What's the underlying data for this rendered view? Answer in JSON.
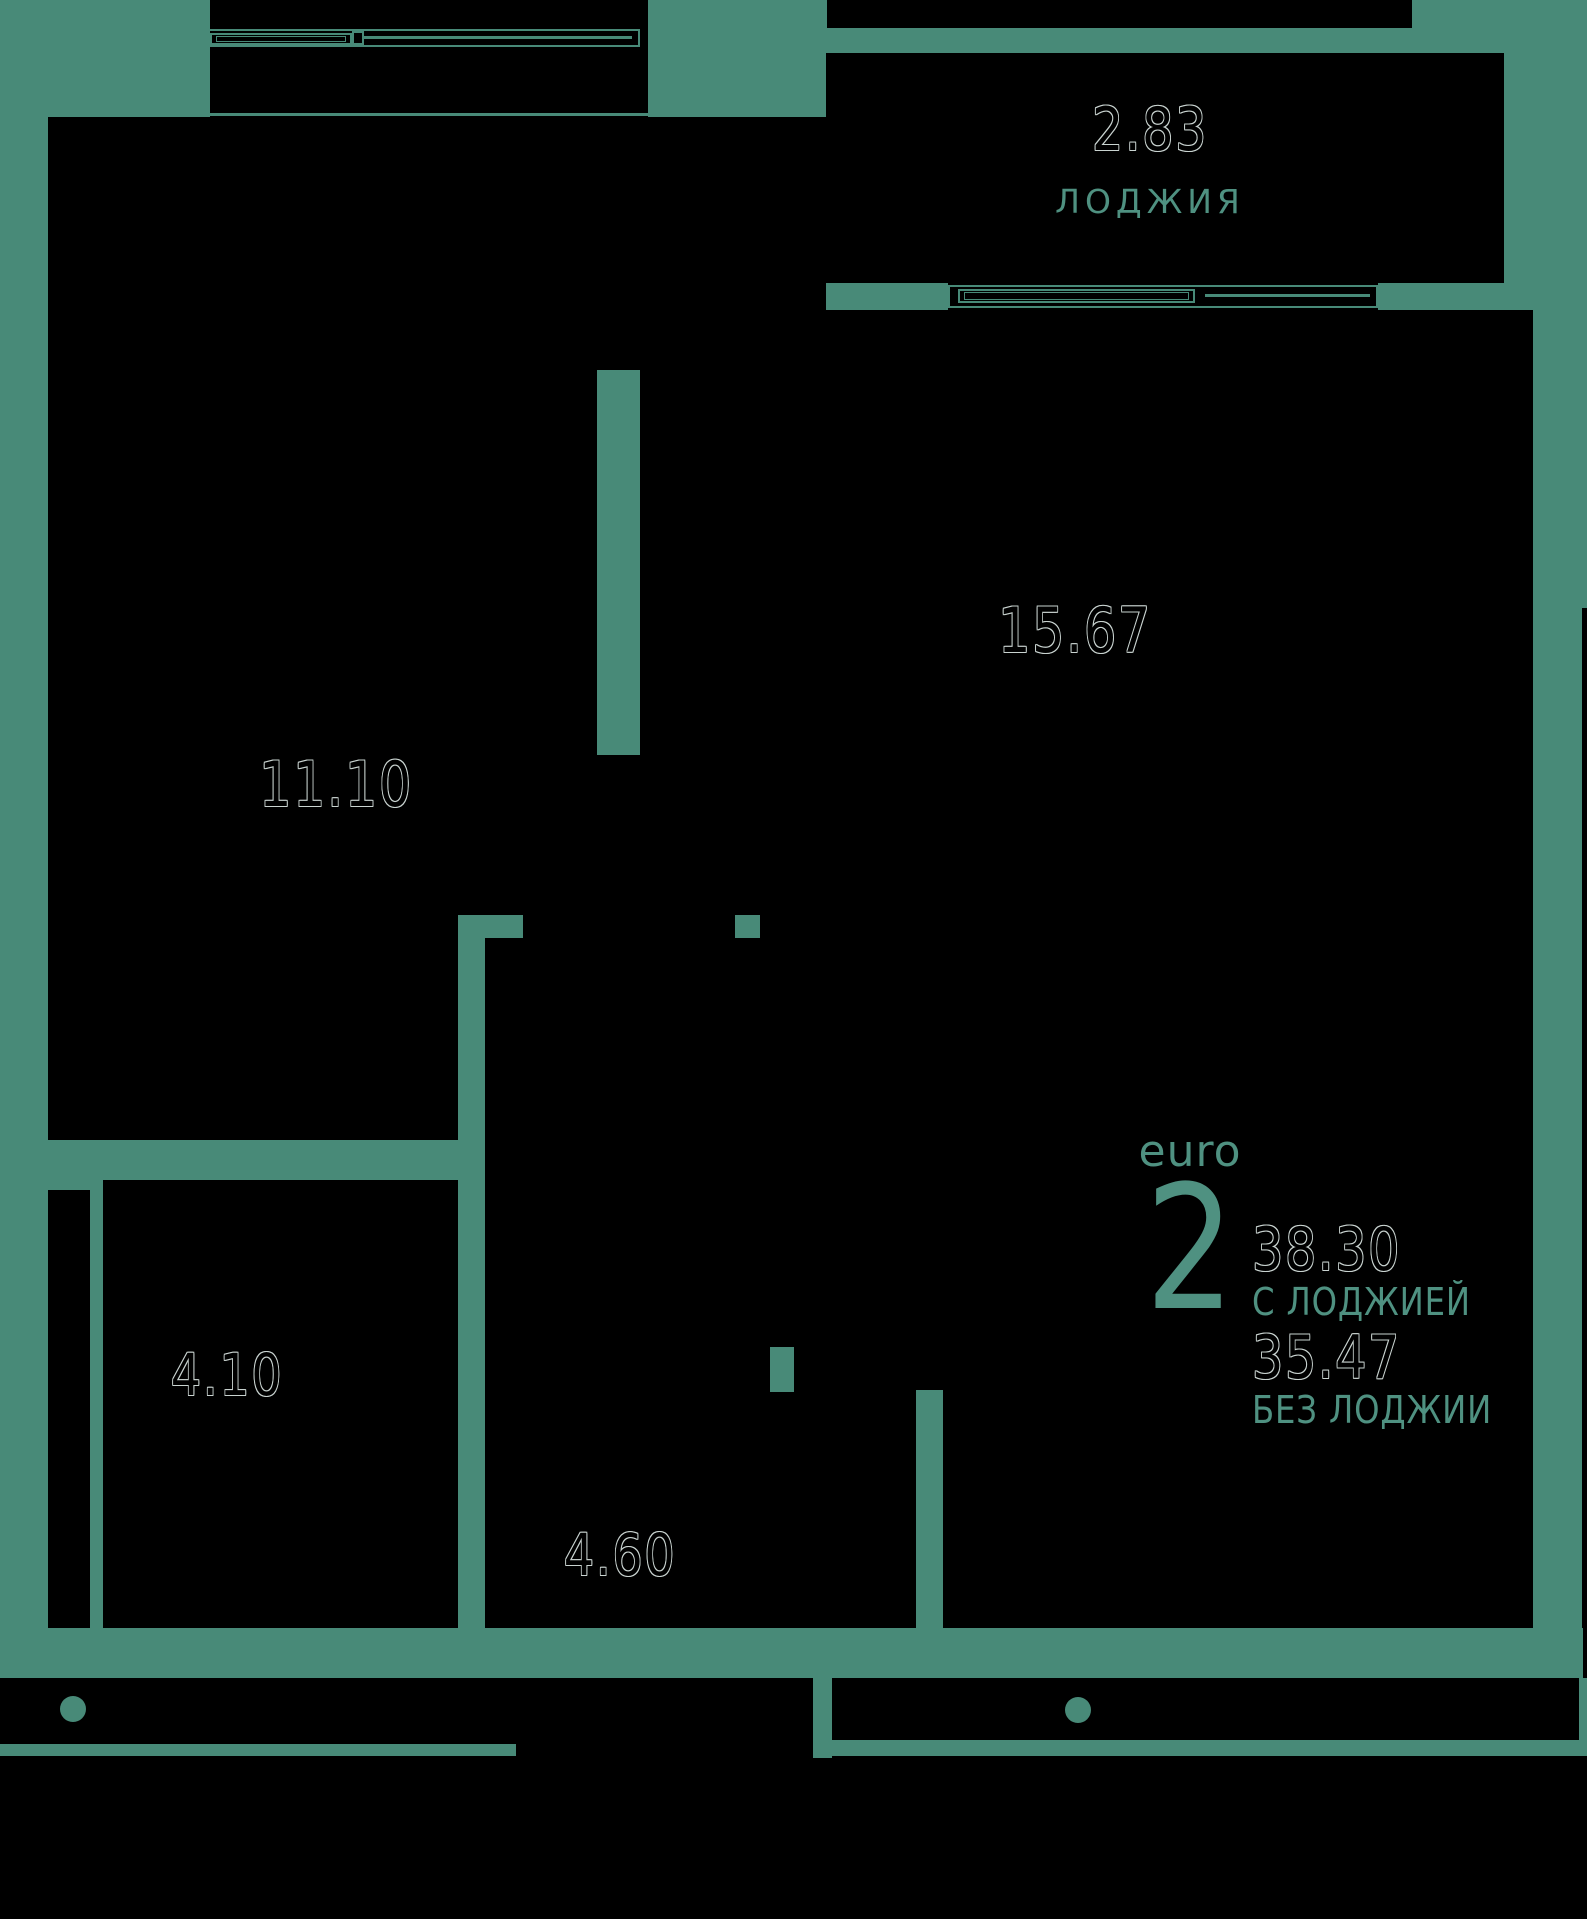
{
  "colors": {
    "background_teal": "#488A78",
    "text_teal": "#4F9181",
    "room_fill": "#000000",
    "number_outline": "#C9D3D0"
  },
  "floorplan": {
    "loggia": {
      "area": "2.83",
      "name": "ЛОДЖИЯ"
    },
    "living_room": {
      "area": "15.67"
    },
    "bedroom": {
      "area": "11.10"
    },
    "bathroom": {
      "area": "4.10"
    },
    "hallway": {
      "area": "4.60"
    }
  },
  "summary": {
    "plan_type": "euro",
    "rooms_count": "2",
    "area_with_loggia": "38.30",
    "with_loggia_label": "С ЛОДЖИЕЙ",
    "area_without_loggia": "35.47",
    "without_loggia_label": "БЕЗ ЛОДЖИИ"
  }
}
